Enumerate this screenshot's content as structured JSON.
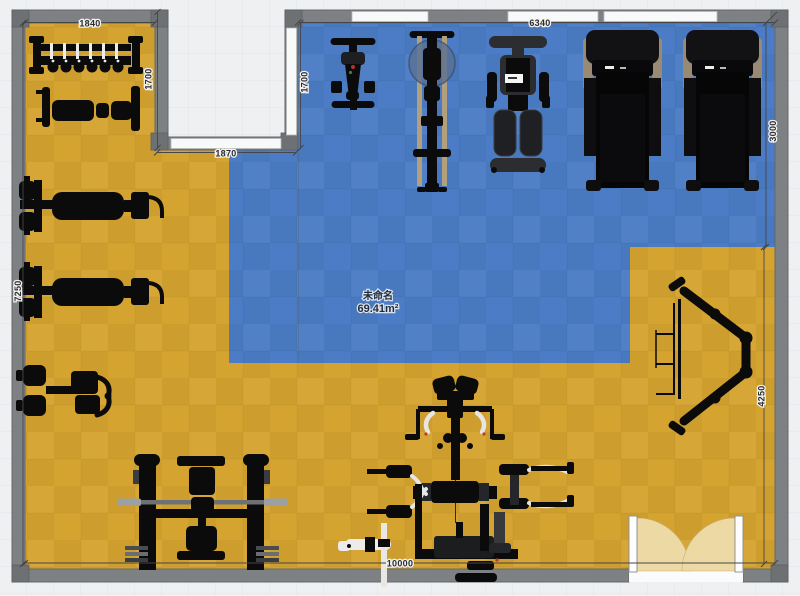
{
  "app": {
    "view": "gym-floor-plan-editor"
  },
  "room": {
    "name": "未命名",
    "area": "69.41m²"
  },
  "dimensions": {
    "wing_top_width": "1840",
    "wing_right_height": "1700",
    "notch_width": "1870",
    "hall_left_height": "1700",
    "hall_top_width": "6340",
    "right_wall_upper": "3000",
    "right_wall_lower": "4250",
    "left_wall": "7250",
    "bottom_wall": "10000"
  },
  "colors": {
    "background": "#eef0f2",
    "wall": "#7e8184",
    "floor_yellow": "#d5a430",
    "floor_blue": "#4b7cc5",
    "door_swing": "#ecd9a4",
    "equipment": "#0b0b0c"
  },
  "equipment": {
    "dumbbell_rack": "Dumbbell rack",
    "flat_bench": "Flat bench",
    "press_machine_1": "Plate-loaded press machine",
    "press_machine_2": "Plate-loaded press machine",
    "storage_bench": "Adjustable bench with plate storage",
    "bench_press_station": "Bench press rack with barbell",
    "multi_gym": "Multi-station gym",
    "hack_squat": "Hack squat / leg press frame",
    "spin_bike": "Spin bike",
    "rower": "Rowing machine",
    "leg_press": "Dual leg press machine",
    "treadmill_1": "Treadmill",
    "treadmill_2": "Treadmill"
  }
}
